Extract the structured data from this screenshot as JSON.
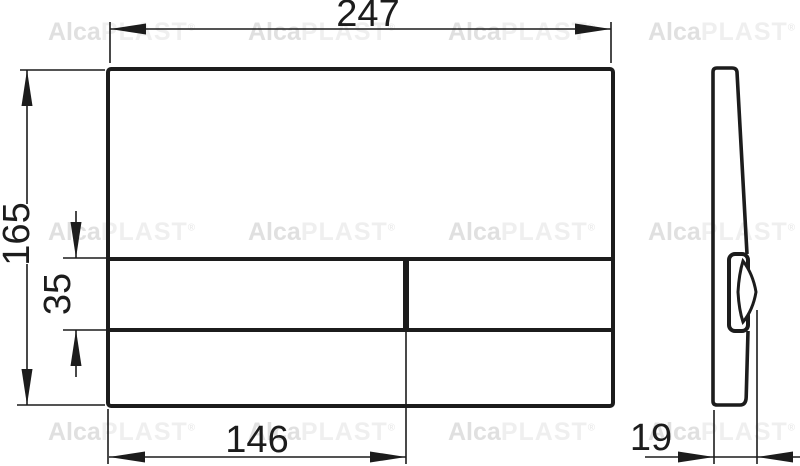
{
  "drawing": {
    "type": "technical-dimension-drawing",
    "views": {
      "front_view": "flush-plate-front",
      "side_view": "flush-plate-side-profile"
    },
    "dims": {
      "overall_width": "247",
      "overall_height": "165",
      "button_strip_height": "35",
      "button_width": "146",
      "depth": "19"
    },
    "watermark": {
      "bold": "Alca",
      "light": "PLAST",
      "reg": "®"
    },
    "colors": {
      "line": "#1c1c1c",
      "watermark_bold": "#e0e0e0",
      "watermark_light": "#efefef",
      "background": "#ffffff"
    }
  }
}
